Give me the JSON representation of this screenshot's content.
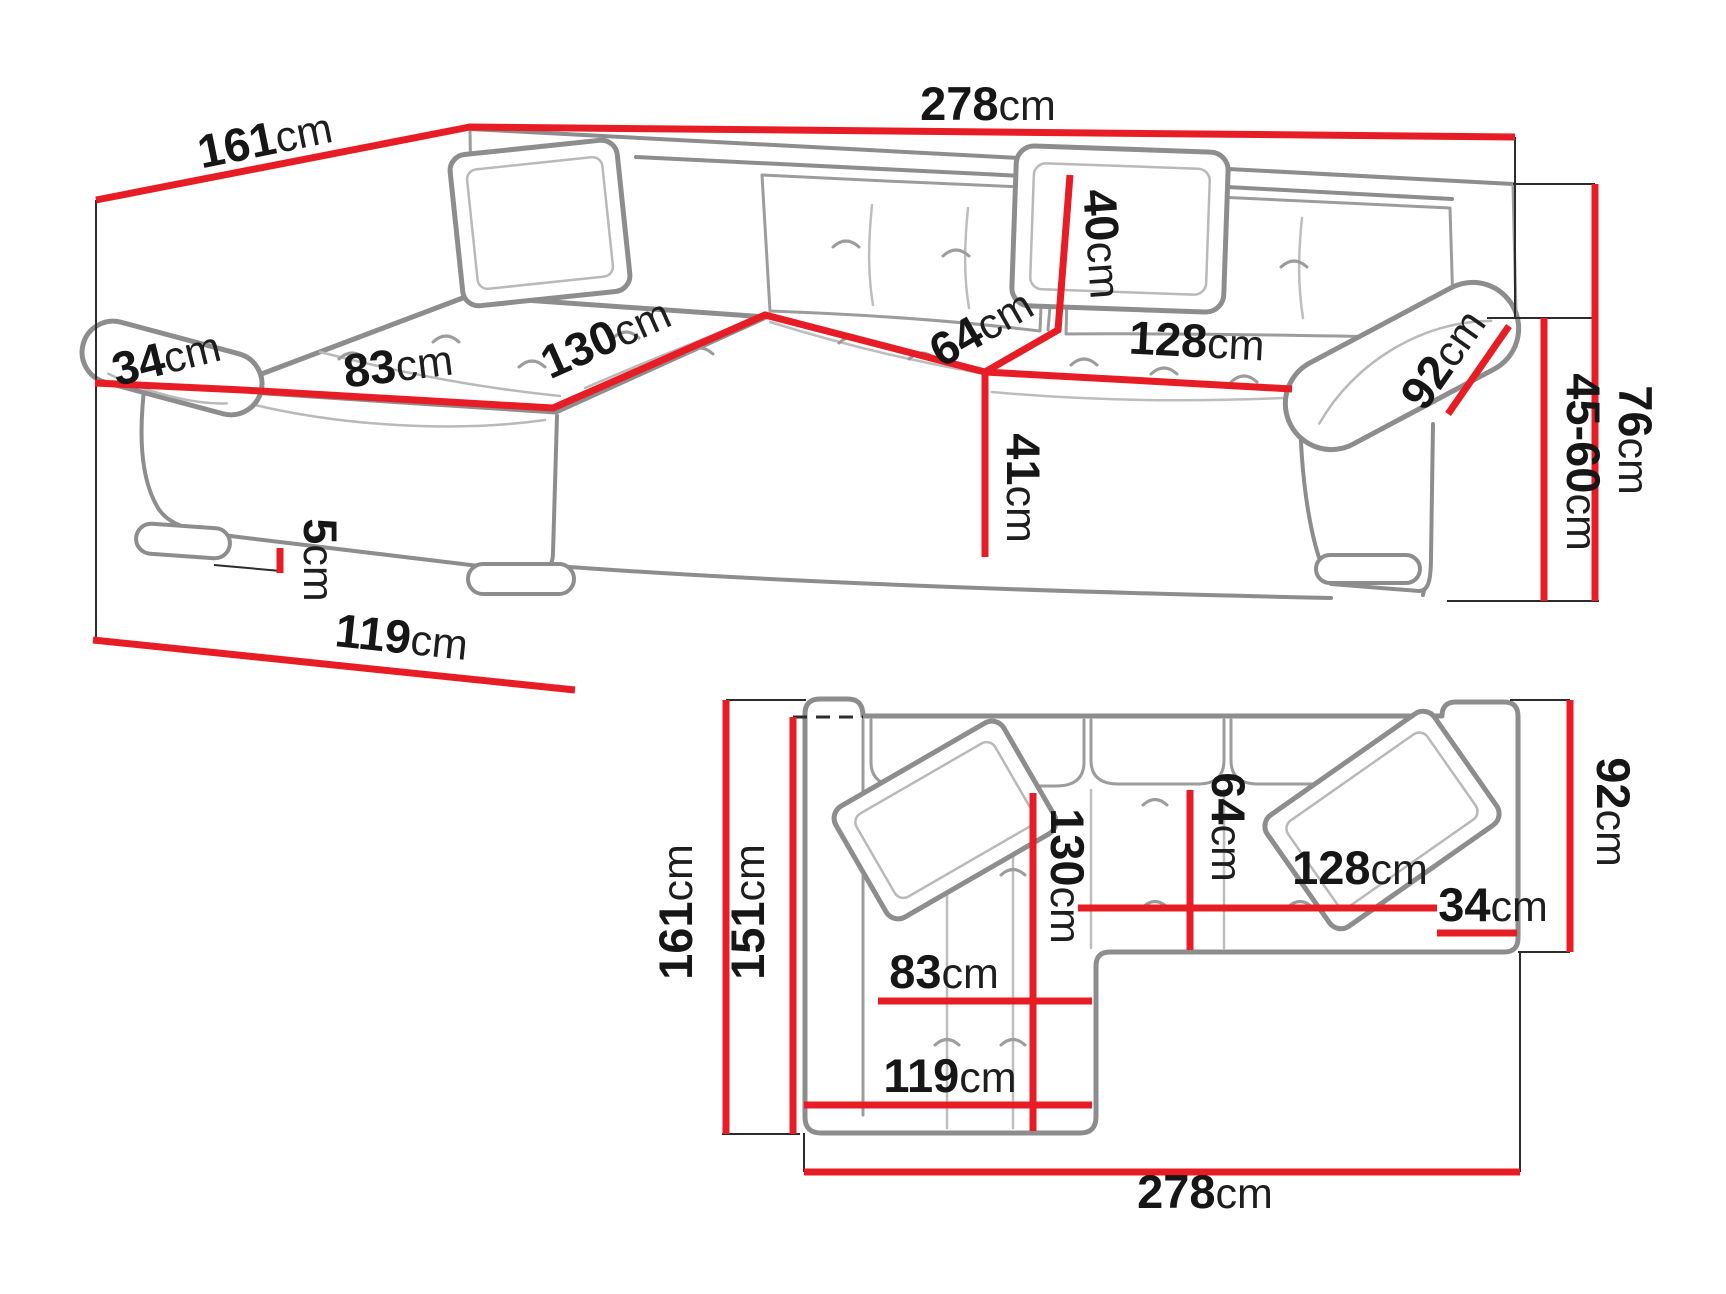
{
  "figure": {
    "description": "Corner sofa technical dimension diagram with perspective view and top (plan) view",
    "unit": "cm"
  },
  "colors": {
    "dimension_red": "#e81c24",
    "outline_gray": "#8d8d8d",
    "label_black": "#161616"
  },
  "views": {
    "perspective": {
      "name": "perspective-view",
      "dims": {
        "d161": {
          "value": "161",
          "unit": "cm"
        },
        "d278": {
          "value": "278",
          "unit": "cm"
        },
        "d34": {
          "value": "34",
          "unit": "cm"
        },
        "d83": {
          "value": "83",
          "unit": "cm"
        },
        "d130": {
          "value": "130",
          "unit": "cm"
        },
        "d40": {
          "value": "40",
          "unit": "cm"
        },
        "d64": {
          "value": "64",
          "unit": "cm"
        },
        "d128": {
          "value": "128",
          "unit": "cm"
        },
        "d92": {
          "value": "92",
          "unit": "cm"
        },
        "d41": {
          "value": "41",
          "unit": "cm"
        },
        "d5": {
          "value": "5",
          "unit": "cm"
        },
        "d119": {
          "value": "119",
          "unit": "cm"
        },
        "d45_60": {
          "value": "45-60",
          "unit": "cm"
        },
        "d76": {
          "value": "76",
          "unit": "cm"
        }
      }
    },
    "plan": {
      "name": "top-view",
      "dims": {
        "d161": {
          "value": "161",
          "unit": "cm"
        },
        "d151": {
          "value": "151",
          "unit": "cm"
        },
        "d130": {
          "value": "130",
          "unit": "cm"
        },
        "d83": {
          "value": "83",
          "unit": "cm"
        },
        "d119": {
          "value": "119",
          "unit": "cm"
        },
        "d278": {
          "value": "278",
          "unit": "cm"
        },
        "d64": {
          "value": "64",
          "unit": "cm"
        },
        "d128": {
          "value": "128",
          "unit": "cm"
        },
        "d34": {
          "value": "34",
          "unit": "cm"
        },
        "d92": {
          "value": "92",
          "unit": "cm"
        }
      }
    }
  }
}
